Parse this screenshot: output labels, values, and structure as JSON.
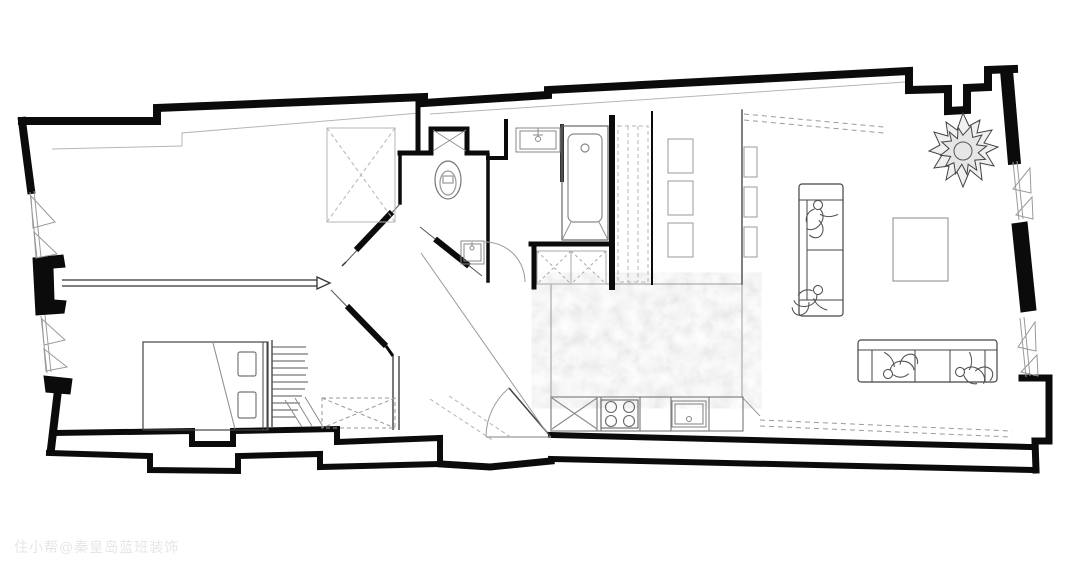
{
  "page": {
    "background": "#ffffff"
  },
  "watermark": {
    "text": "住小帮@秦皇岛蓝班装饰"
  },
  "floor_plan": {
    "type": "apartment-floor-plan",
    "colors": {
      "walls": "#0b0b0b",
      "medium_lines": "#555555",
      "thin_lines": "#8a8a8a",
      "light_lines": "#b5b5b5",
      "floor_texture": "#d9d9d9",
      "background": "#ffffff"
    },
    "elements": [
      "exterior-walls",
      "casement-windows",
      "partition-wall-arrow",
      "sliding-doors",
      "double-bed",
      "coat-rack",
      "dashed-wardrobe",
      "closet-dashed-x",
      "wc-toilet",
      "wc-corner-sink",
      "duct-shaft",
      "wc-door-swing",
      "bath-vanity-sink",
      "bathtub",
      "shower-dashed-x",
      "dashed-cabinet-column",
      "kitchen-marble-floor",
      "kitchen-counter",
      "cabinet-x",
      "cooktop-4-burners",
      "kitchen-sink",
      "tall-cabinets",
      "shelving-unit",
      "sofa-vertical",
      "sofa-horizontal",
      "seated-figures",
      "rug",
      "potted-plant",
      "entry-door-swing",
      "radiator-dashed-lines"
    ]
  }
}
